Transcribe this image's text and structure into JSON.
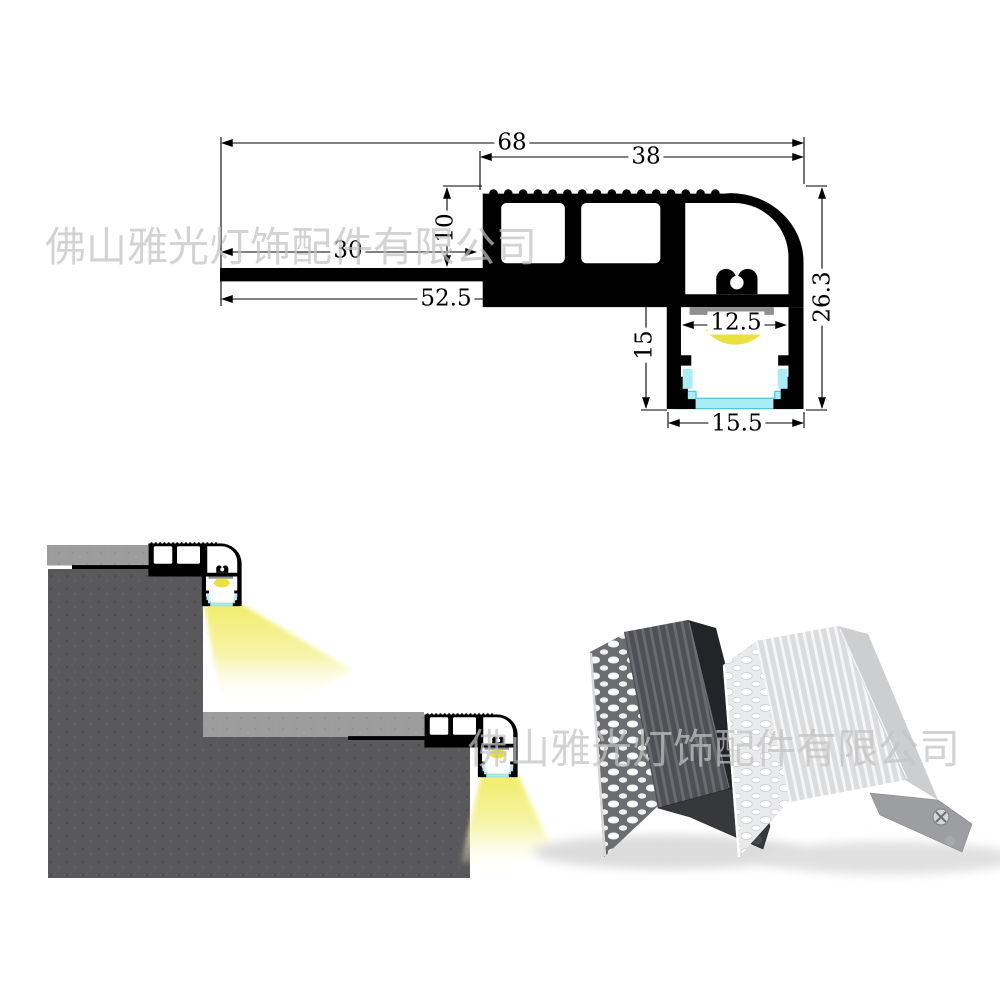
{
  "company_watermark": "佛山雅光灯饰配件有限公司",
  "technical_drawing": {
    "dimensions": {
      "overall_width": "68",
      "top_section_width": "38",
      "top_section_height": "10",
      "flange_length": "30",
      "base_length": "52.5",
      "led_channel_height": "15",
      "led_opening_width": "12.5",
      "overall_height": "26.3",
      "channel_outer_width": "15.5"
    },
    "colors": {
      "outline": "#000000",
      "pcb_strip": "#8f8f8f",
      "led_glow": "#e9e13c",
      "diffuser": "#a9ecf6"
    }
  },
  "installation_diagram": {
    "colors": {
      "concrete": "#59595b",
      "tile": "#9c9c9c",
      "light_beam": "#f0ec62"
    }
  },
  "product_photo": {
    "items": [
      {
        "finish": "black",
        "color": "#54555a"
      },
      {
        "finish": "silver",
        "color": "#e4e5e6"
      }
    ]
  }
}
